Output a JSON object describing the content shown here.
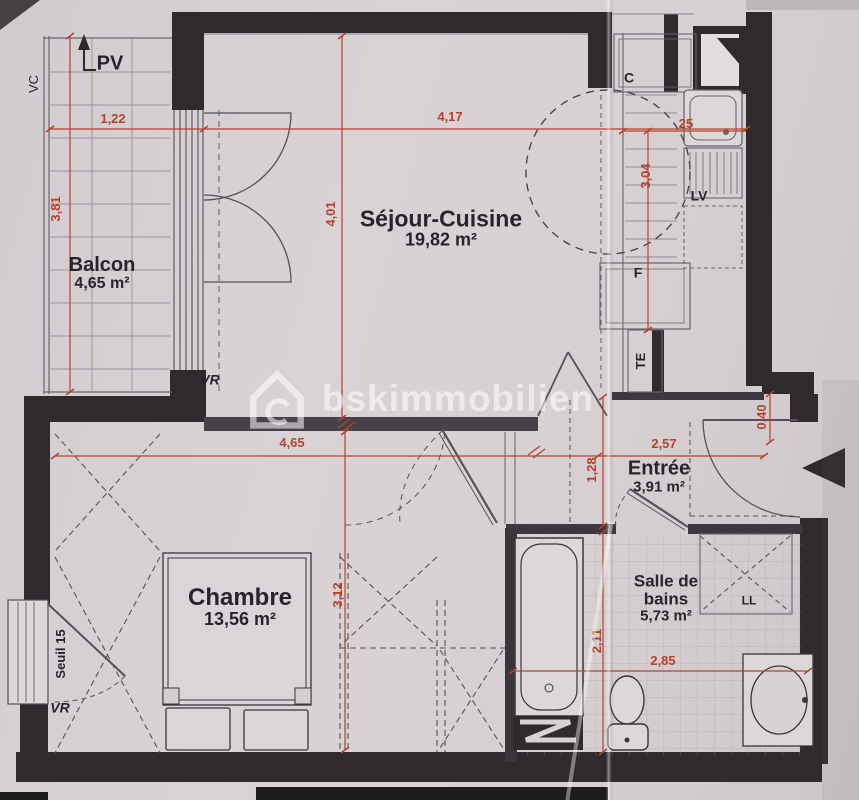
{
  "watermark": {
    "text": "bskimmobilien"
  },
  "rooms": {
    "balcon": {
      "name": "Balcon",
      "area": "4,65 m²"
    },
    "sejour": {
      "name": "Séjour-Cuisine",
      "area": "19,82 m²"
    },
    "chambre": {
      "name": "Chambre",
      "area": "13,56 m²"
    },
    "entree": {
      "name": "Entrée",
      "area": "3,91 m²"
    },
    "sdb": {
      "name": "Salle de bains",
      "area": "5,73 m²"
    }
  },
  "fixtures": {
    "pv": "PV",
    "vc": "VC",
    "vr_balcon": "VR",
    "vr_chambre": "VR",
    "seuil": "Seuil 15",
    "c": "C",
    "lv": "LV",
    "f": "F",
    "te": "TE",
    "ll": "LL"
  },
  "dimensions": {
    "balcon_width": "1,22",
    "sejour_width": "4,17",
    "balcon_depth": "3,81",
    "sejour_depth": "4,01",
    "cuisine_depth": "3,04",
    "cuisine_width": "25",
    "entree_offset": "0,40",
    "chambre_width": "4,65",
    "entree_width": "2,57",
    "entree_depth": "1,28",
    "chambre_depth": "3,12",
    "sdb_depth": "2,11",
    "sdb_width": "2,85"
  },
  "colors": {
    "paper": "#d6d0d3",
    "wall": "#2e2a2d",
    "dimension_red": "#b5432c",
    "label_ink": "#28242e",
    "line_grey": "#6a6470"
  }
}
